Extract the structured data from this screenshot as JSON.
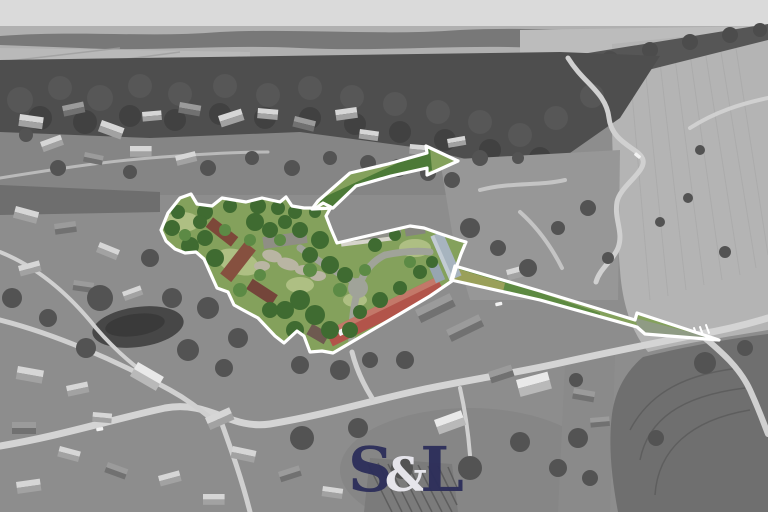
{
  "scene": {
    "type": "aerial-drone-photo",
    "style": "grayscale countryside with color-highlighted property boundary",
    "highlight_arrows": 2
  },
  "palette": {
    "sky": "#dadada",
    "outline": "#ffffff",
    "meadow": "#84a15c",
    "tree_green": "#3f6b31",
    "roof_red": "#b2544a",
    "roof_blue": "#a7b4bf",
    "pond": "#474747",
    "road": "#d4d4d4"
  },
  "watermark": {
    "s": "S",
    "amp": "&",
    "l": "L",
    "letter_color": "#2c2e5a",
    "amp_color": "#ecebf2"
  }
}
